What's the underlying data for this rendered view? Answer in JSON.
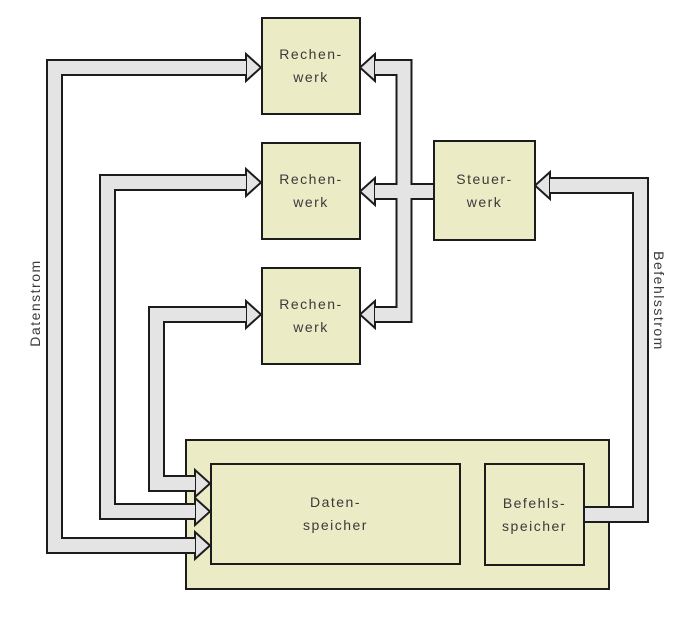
{
  "diagram_title": "SIMD architecture block diagram",
  "boxes": {
    "rechenwerk": {
      "line1": "Rechen-",
      "line2": "werk"
    },
    "steuerwerk": {
      "line1": "Steuer-",
      "line2": "werk"
    },
    "datenspeicher": {
      "line1": "Daten-",
      "line2": "speicher"
    },
    "befehlsspeicher": {
      "line1": "Befehls-",
      "line2": "speicher"
    }
  },
  "stream_labels": {
    "left": "Datenstrom",
    "right": "Befehlsstrom"
  },
  "connections": [
    "Datenspeicher <-> Rechenwerk 1 (data path, arrows both ends)",
    "Datenspeicher <-> Rechenwerk 2 (data path, arrows both ends)",
    "Datenspeicher <-> Rechenwerk 3 (data path, arrows both ends)",
    "Steuerwerk -> Rechenwerk 1",
    "Steuerwerk -> Rechenwerk 2",
    "Steuerwerk -> Rechenwerk 3",
    "Befehlsspeicher -> Steuerwerk"
  ],
  "colors": {
    "box_fill": "#ebebc6",
    "box_border": "#1c1c1c",
    "band_fill": "#e4e4e4",
    "band_border": "#1c1c1c",
    "text": "#3a3a3a",
    "background": "#ffffff"
  }
}
